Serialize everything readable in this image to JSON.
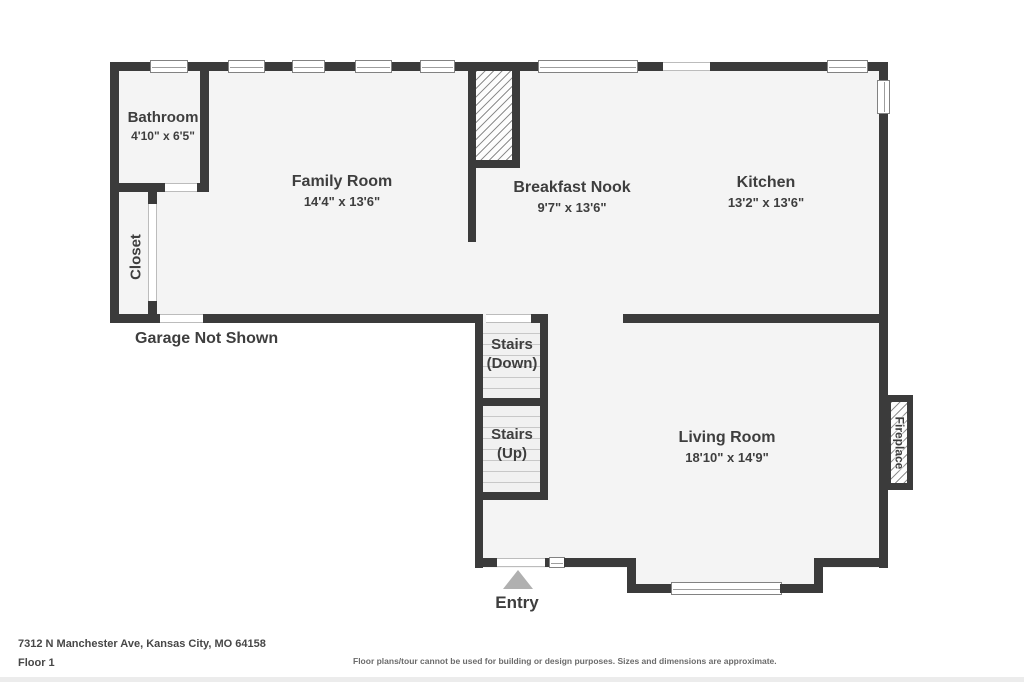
{
  "colors": {
    "wall": "#3b3b3b",
    "floor": "#f4f4f4",
    "text": "#3e3e3e",
    "entry_arrow": "#b0b0b0"
  },
  "rooms": {
    "bathroom": {
      "name": "Bathroom",
      "dims": "4'10\" x 6'5\""
    },
    "closet": {
      "name": "Closet"
    },
    "family_room": {
      "name": "Family Room",
      "dims": "14'4\" x 13'6\""
    },
    "breakfast_nook": {
      "name": "Breakfast Nook",
      "dims": "9'7\" x 13'6\""
    },
    "kitchen": {
      "name": "Kitchen",
      "dims": "13'2\" x 13'6\""
    },
    "living_room": {
      "name": "Living Room",
      "dims": "18'10\" x 14'9\""
    }
  },
  "features": {
    "stairs_down": {
      "line1": "Stairs",
      "line2": "(Down)"
    },
    "stairs_up": {
      "line1": "Stairs",
      "line2": "(Up)"
    },
    "fireplace": {
      "label": "Fireplace"
    },
    "entry": {
      "label": "Entry"
    },
    "garage_note": "Garage Not Shown"
  },
  "footer": {
    "address": "7312 N Manchester Ave, Kansas City, MO 64158",
    "floor_label": "Floor 1",
    "disclaimer": "Floor plans/tour cannot be used for building or design purposes. Sizes and dimensions are approximate."
  }
}
